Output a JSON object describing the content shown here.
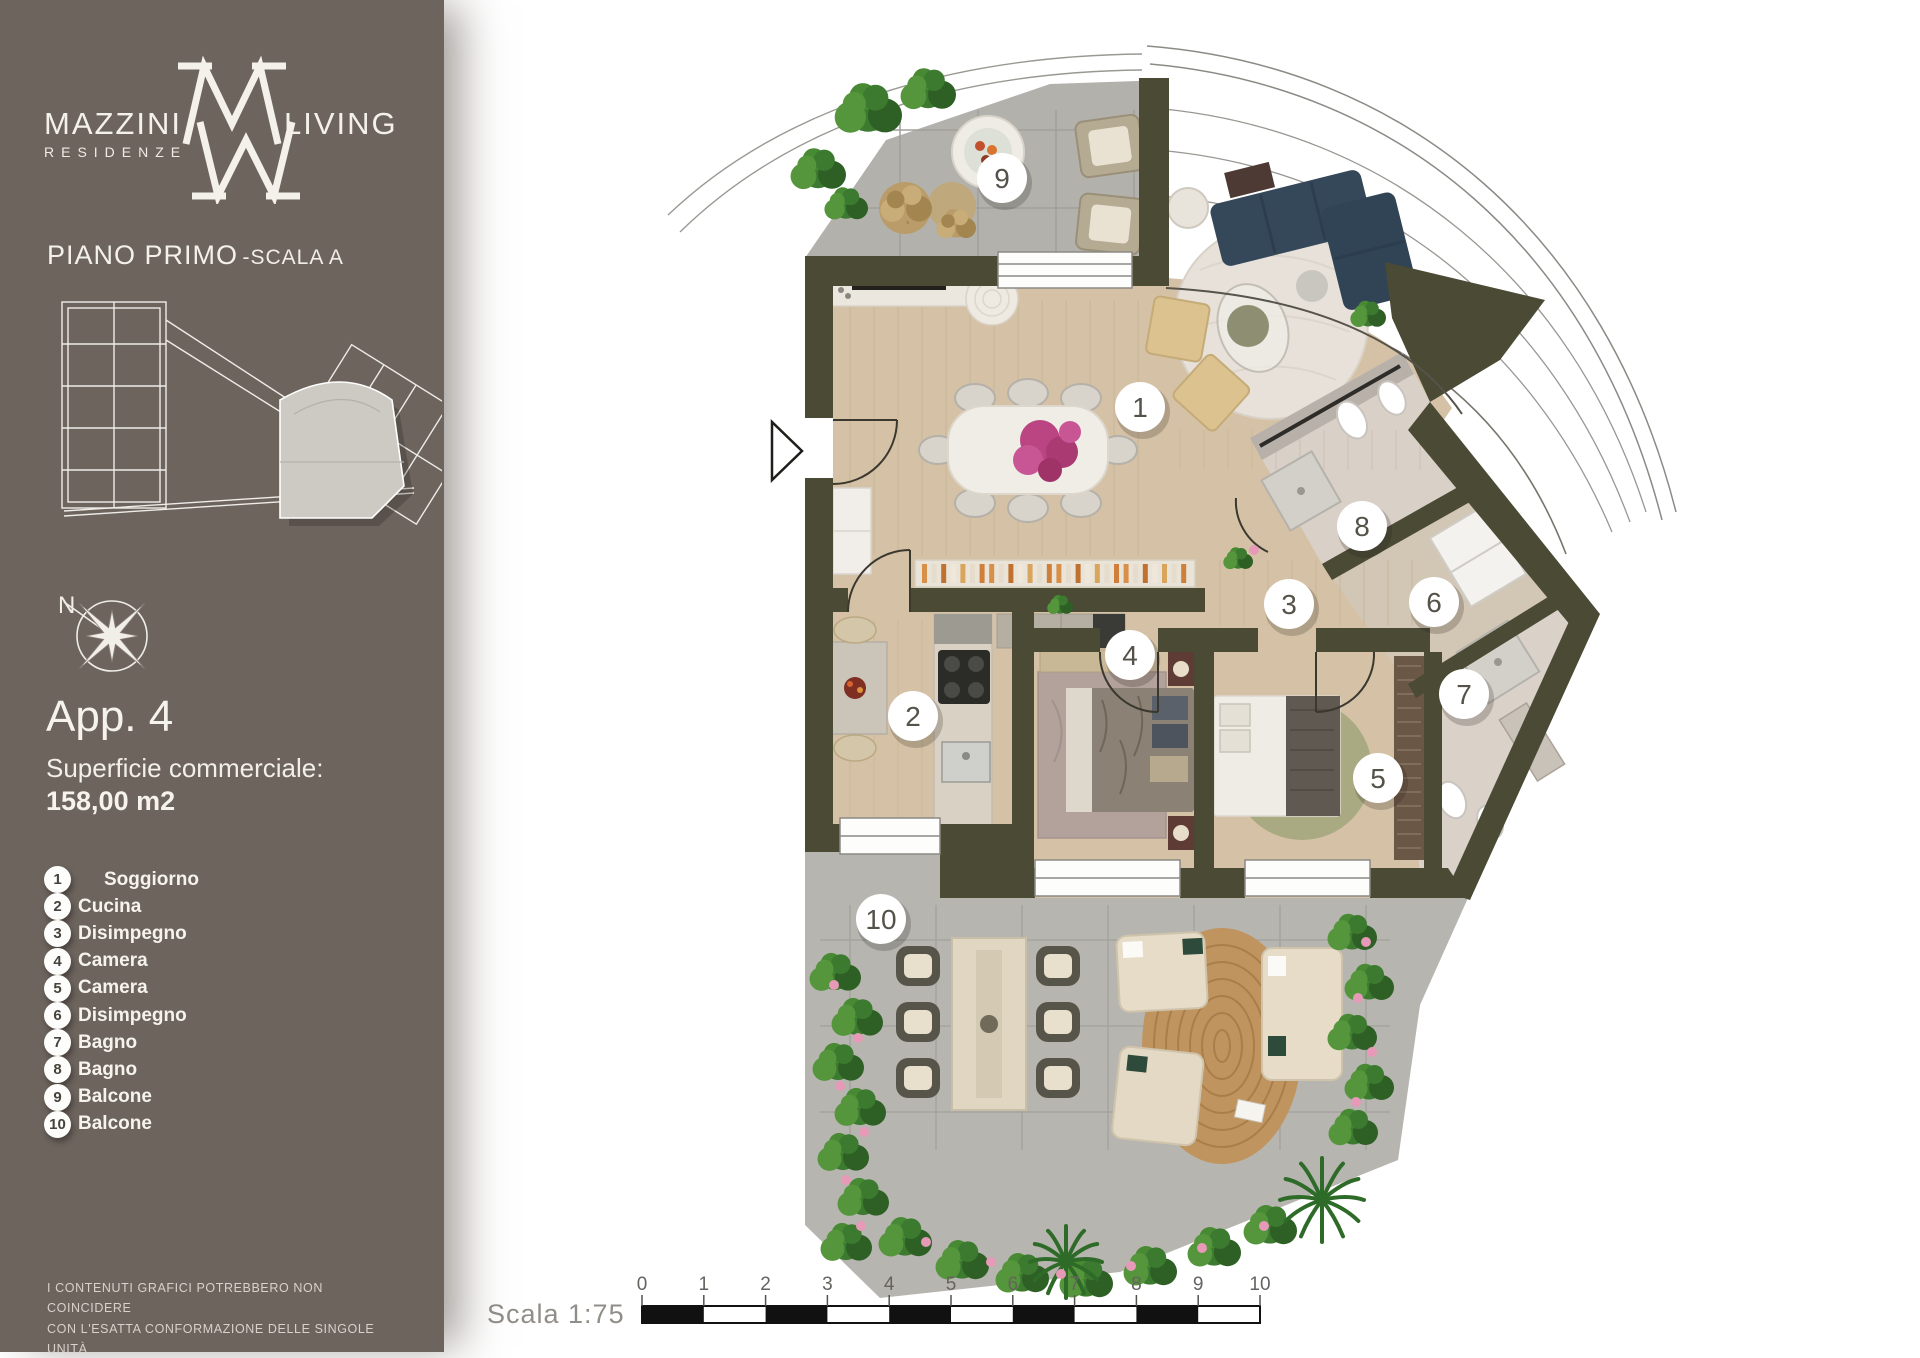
{
  "sidebar": {
    "brand": {
      "name_left": "MAZZINI",
      "name_right": "LIVING",
      "sub": "RESIDENZE"
    },
    "floor_title": "PIANO PRIMO",
    "floor_subtitle": "-SCALA A",
    "compass_north": "N",
    "apartment": {
      "title": "App. 4",
      "area_label": "Superficie commerciale:",
      "area_value": "158,00 m2"
    },
    "legend": {
      "items": [
        {
          "num": "1",
          "label": "Soggiorno"
        },
        {
          "num": "2",
          "label": "Cucina"
        },
        {
          "num": "3",
          "label": "Disimpegno"
        },
        {
          "num": "4",
          "label": "Camera"
        },
        {
          "num": "5",
          "label": "Camera"
        },
        {
          "num": "6",
          "label": "Disimpegno"
        },
        {
          "num": "7",
          "label": "Bagno"
        },
        {
          "num": "8",
          "label": "Bagno"
        },
        {
          "num": "9",
          "label": "Balcone"
        },
        {
          "num": "10",
          "label": "Balcone"
        }
      ]
    },
    "disclaimer_line1": "I CONTENUTI GRAFICI POTREBBERO NON COINCIDERE",
    "disclaimer_line2": "CON L'ESATTA CONFORMAZIONE DELLE SINGOLE UNITÀ"
  },
  "plan": {
    "markers": [
      "1",
      "2",
      "3",
      "4",
      "5",
      "6",
      "7",
      "8",
      "9",
      "10"
    ]
  },
  "scalebar": {
    "label": "Scala 1:75",
    "ticks": [
      "0",
      "1",
      "2",
      "3",
      "4",
      "5",
      "6",
      "7",
      "8",
      "9",
      "10"
    ]
  },
  "colors": {
    "sidebar_bg": "#6d645e",
    "wall_olive": "#4a4a35",
    "wood_floor": "#d5c2a6",
    "tile_gray": "#b3b1ac",
    "sofa_navy": "#35485a",
    "plant_green": "#4a8a36",
    "accent_magenta": "#bb4583"
  }
}
